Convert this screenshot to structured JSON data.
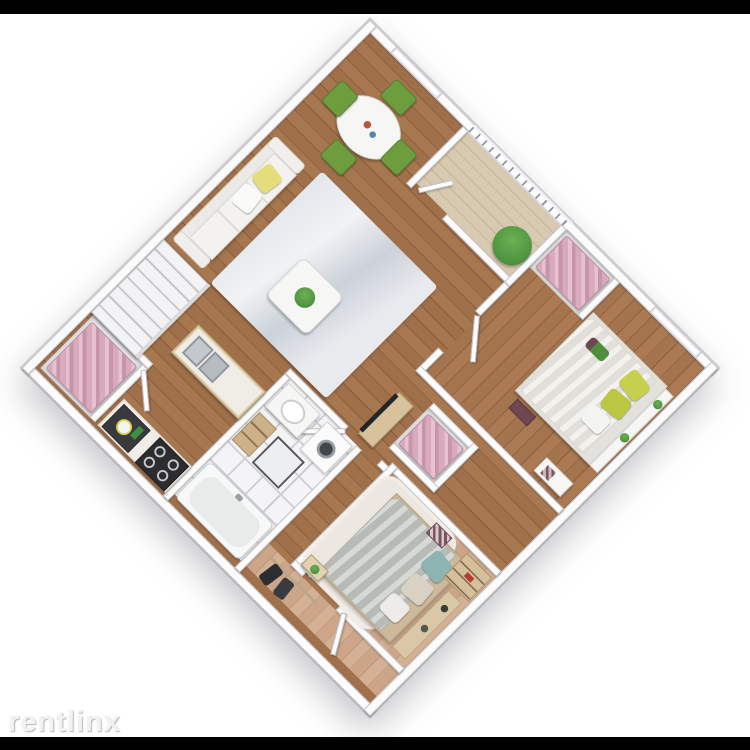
{
  "meta": {
    "image_type": "3D apartment floor plan render",
    "view": "isometric overhead, plan rotated 45 degrees",
    "letterbox_bar_color": "#000000",
    "background_color": "#ffffff"
  },
  "watermark": {
    "text": "rentlinx"
  },
  "scene": {
    "layout": "2-bedroom 1-bath apartment with balcony and interior staircase",
    "rooms": [
      {
        "name": "Dining Area",
        "floor": "hardwood",
        "contents": [
          "round white dining table",
          "4 green chairs",
          "tall window"
        ]
      },
      {
        "name": "Balcony",
        "floor": "wood deck planks",
        "contents": [
          "metal railing with balusters",
          "potted green plant",
          "glass door to dining"
        ]
      },
      {
        "name": "Bedroom 1",
        "floor": "hardwood",
        "contents": [
          "double bed with white duvet",
          "two yellow-green pillows",
          "white pillow",
          "flower decor on bed",
          "headboard shelf with two plants",
          "books on floor",
          "white bench with patterned decor",
          "window",
          "closet with pink clothes"
        ]
      },
      {
        "name": "Living Room",
        "floor": "hardwood",
        "contents": [
          "white sofa",
          "yellow pillow",
          "white pillow",
          "light gray rug",
          "white coffee table with green plant",
          "TV on light-wood media console"
        ]
      },
      {
        "name": "Hallway",
        "floor": "hardwood",
        "contents": [
          "closet with pink clothes",
          "white staircase along outer wall"
        ]
      },
      {
        "name": "Kitchen",
        "floor": "hardwood",
        "contents": [
          "wall counter with dark sink module and white pot",
          "green bottles",
          "4-burner gas stove",
          "island counter with stainless double sink"
        ]
      },
      {
        "name": "Bathroom",
        "floor": "white tile with gray grout",
        "contents": [
          "washing machine with round door",
          "vanity with oval basin",
          "wooden ladder shelf",
          "shower tray with dark frame",
          "white bathtub"
        ]
      },
      {
        "name": "Bedroom 2",
        "floor": "light washed hardwood",
        "contents": [
          "double bed with gray-green duvet",
          "teal pillow",
          "beige pillow",
          "white pillow",
          "white shag rug",
          "wooden dresser shelf with red book",
          "long bench with candles",
          "nightstand with plant",
          "patterned decor bag"
        ]
      },
      {
        "name": "Entry",
        "floor": "light washed hardwood",
        "contents": [
          "coat rack with two dark coats",
          "open front door",
          "open door to bedroom 2"
        ]
      }
    ],
    "colors": {
      "wood_floor": "#9c6b47",
      "wood_floor_light": "#c9a286",
      "deck": "#d5c7ab",
      "tile": "#f4f4f6",
      "grout": "#cdced4",
      "wall": "#fbfbfc",
      "wall_edge": "#c2c2c7",
      "rug_living": "#e3e6eb",
      "rug_shag": "#ece8e1",
      "sofa": "#f3f2ef",
      "pillow_yellow": "#e5dc7c",
      "chair_green": "#6e9d3e",
      "plant_green": "#3d8434",
      "clothes_pink": "#d9aabb",
      "coat_dark": "#2c2d31",
      "bed1_duvet": "#edebe6",
      "bed1_pillow": "#c7d04e",
      "bed2_duvet": "#c2c5bf",
      "bed2_pillow_teal": "#8db4b1",
      "tv_screen": "#232528",
      "wood_furniture": "#d8c29c",
      "stove": "#2d2d30",
      "steel_sink": "#c3c8cc"
    }
  }
}
